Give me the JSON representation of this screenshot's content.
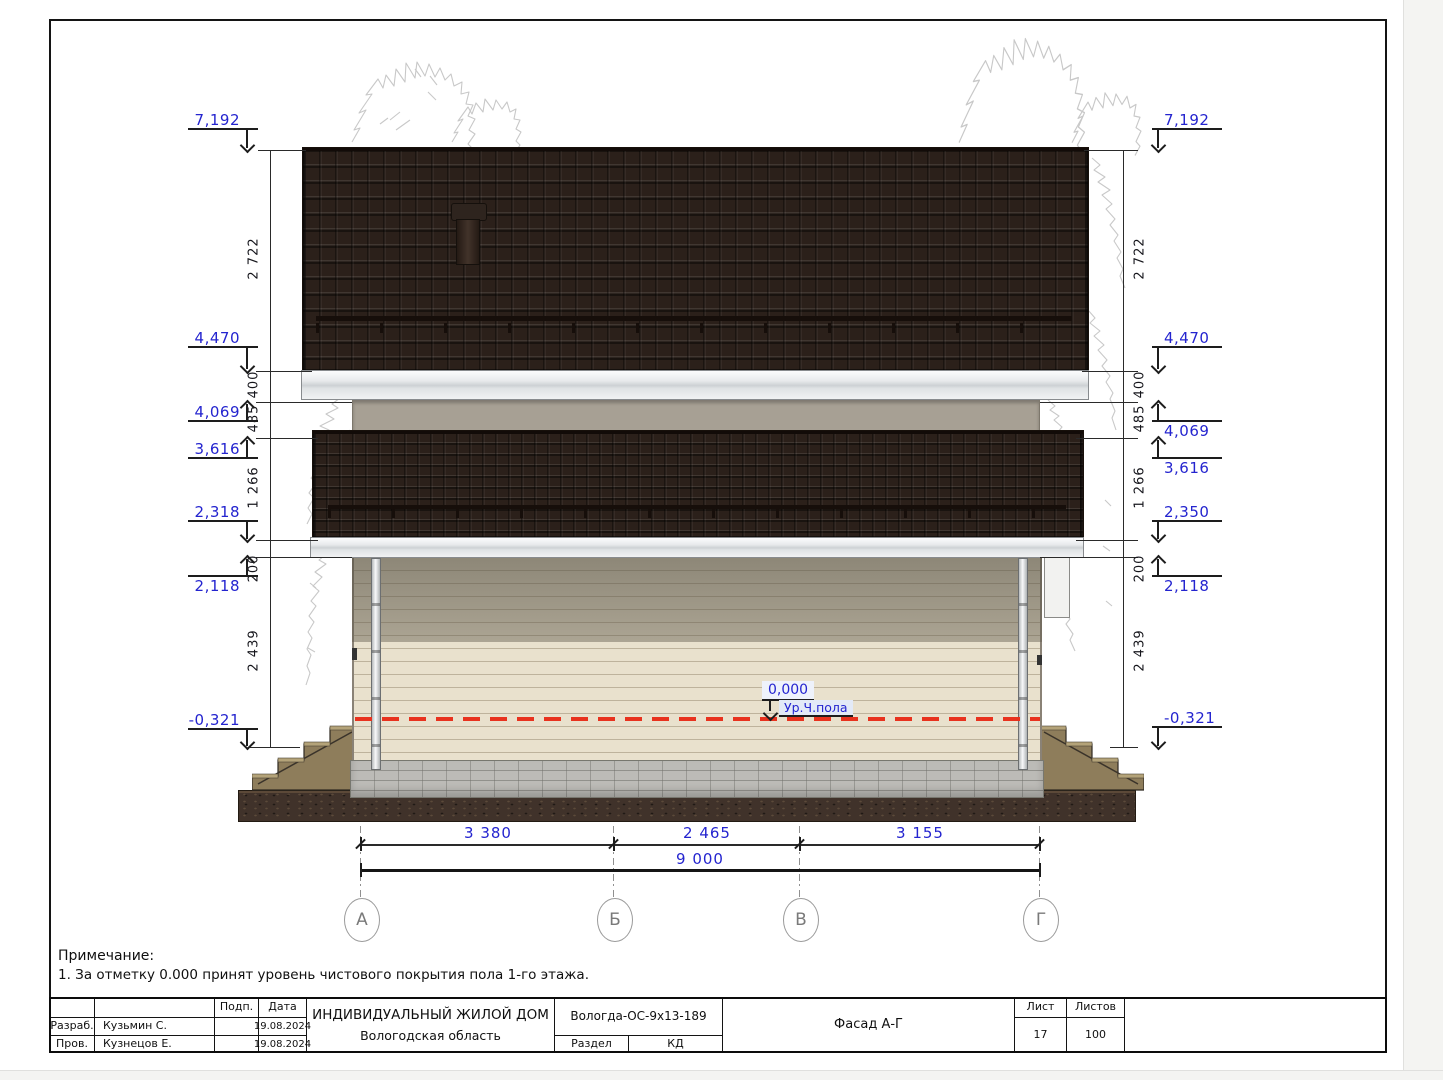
{
  "note": {
    "title": "Примечание:",
    "line1": "1. За отметку 0.000 принят уровень чистового покрытия пола 1-го этажа."
  },
  "title_block": {
    "sign_col": "Подп.",
    "date_col": "Дата",
    "rows": [
      {
        "role": "Разраб.",
        "name": "Кузьмин С.",
        "date": "19.08.2024"
      },
      {
        "role": "Пров.",
        "name": "Кузнецов Е.",
        "date": "19.08.2024"
      }
    ],
    "project_title": "ИНДИВИДУАЛЬНЫЙ ЖИЛОЙ ДОМ",
    "project_subtitle": "Вологодская область",
    "project_code": "Вологда-ОС-9х13-189",
    "section_label": "Раздел",
    "section_value": "КД",
    "drawing_title": "Фасад А-Г",
    "sheet_label": "Лист",
    "sheets_label": "Листов",
    "sheet_number": "17",
    "sheets_total": "100"
  },
  "annotations": {
    "left_marks": [
      "7,192",
      "4,470",
      "4,069",
      "3,616",
      "2,318",
      "2,118",
      "-0,321"
    ],
    "right_marks": [
      "7,192",
      "4,470",
      "4,069",
      "3,616",
      "2,350",
      "2,118",
      "-0,321"
    ],
    "vertical_dims": [
      "2 722",
      "400",
      "485",
      "1 266",
      "200",
      "2 439"
    ],
    "bottom_dims": [
      "3 380",
      "2 465",
      "3 155"
    ],
    "bottom_total": "9 000",
    "axis_labels": [
      "А",
      "Б",
      "В",
      "Г"
    ],
    "floor_mark": {
      "value": "0,000",
      "label": "Ур.Ч.пола"
    }
  },
  "colors": {
    "elevation_text": "#2424cf",
    "dimension_text": "#16161c",
    "level_line_red": "#e8321e",
    "roof_tile": "#2b201a",
    "wall_siding": "#e9e1cd",
    "second_floor_band": "#a7a094",
    "foundation": "#bcbbb7",
    "ground": "#40322a"
  }
}
